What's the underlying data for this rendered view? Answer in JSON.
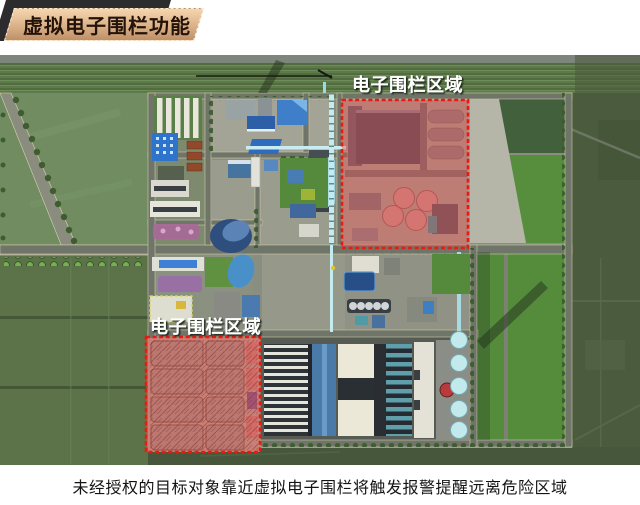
{
  "slide": {
    "title": "虚拟电子围栏功能",
    "caption": "未经授权的目标对象靠近虚拟电子围栏将触发报警提醒远离危险区域"
  },
  "map": {
    "zone_labels": {
      "top": "电子围栏区域",
      "bottom": "电子围栏区域"
    },
    "colors": {
      "fence_fill": "#e0483c",
      "fence_border": "#ea1a10",
      "banner_bg": "#d8ae85",
      "banner_text": "#241309",
      "label_text": "#ffffff"
    }
  }
}
